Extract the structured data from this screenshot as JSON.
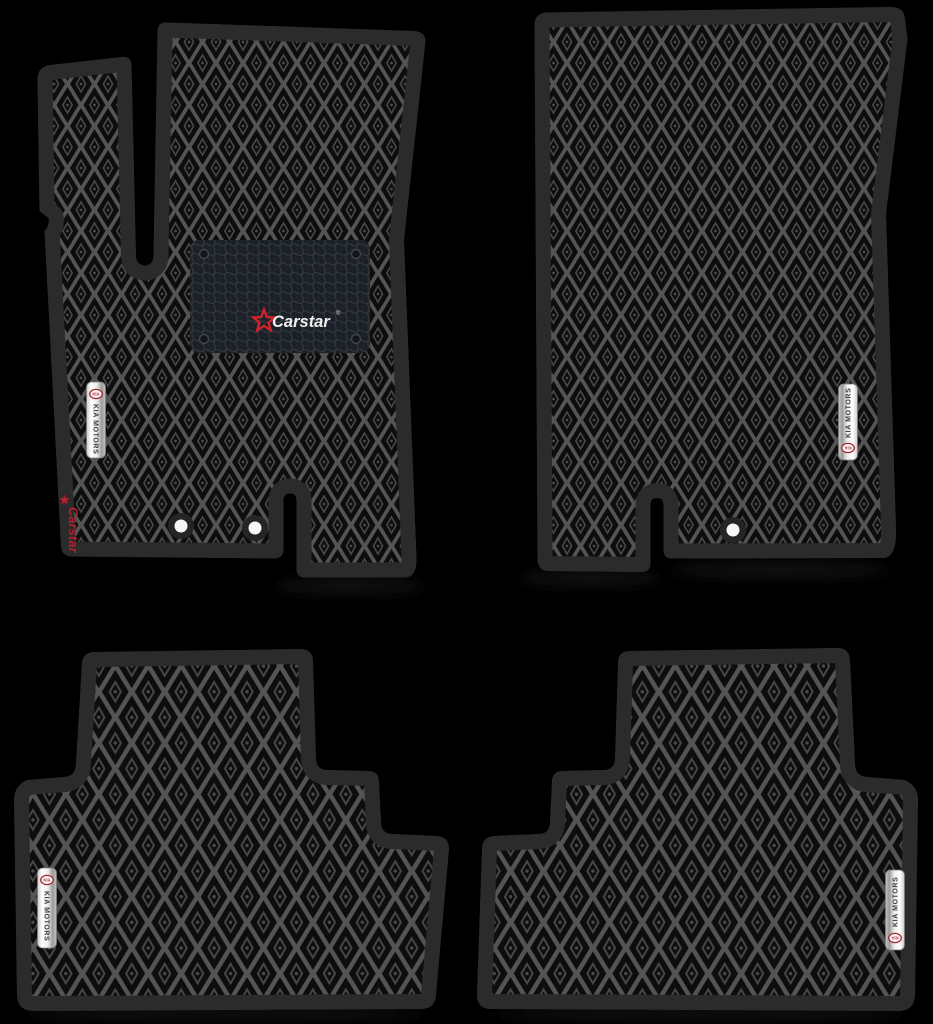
{
  "scene": {
    "background_color": "#000000",
    "mat_edge_color": "#2b2b2b",
    "pattern_lattice_color": "#545454",
    "pattern_cell_color": "#0d0d0d",
    "pattern_ring_color": "#484848"
  },
  "heel_pad": {
    "brand": "Carstar",
    "registered_mark": "®",
    "star_color": "#d2232a",
    "text_color": "#f0f0f0",
    "pad_color": "#1c2027",
    "honeycomb_color": "#31363f"
  },
  "side_brand": {
    "text": "Carstar",
    "color": "#b5202c"
  },
  "kia_badge": {
    "oval_text": "KIA",
    "label": "KIA MOTORS",
    "oval_color": "#a8242c",
    "label_color": "#3a3a3a",
    "plate_light": "#ffffff",
    "plate_dark": "#9a9a9a"
  },
  "mats": {
    "front_driver": {
      "fixing_holes": 2,
      "has_heel_pad": true,
      "has_badge": true,
      "has_side_brand": true
    },
    "front_passenger": {
      "fixing_holes": 1,
      "has_badge": true
    },
    "rear_left": {
      "fixing_holes": 0,
      "has_badge": true
    },
    "rear_right": {
      "fixing_holes": 0,
      "has_badge": true
    }
  }
}
